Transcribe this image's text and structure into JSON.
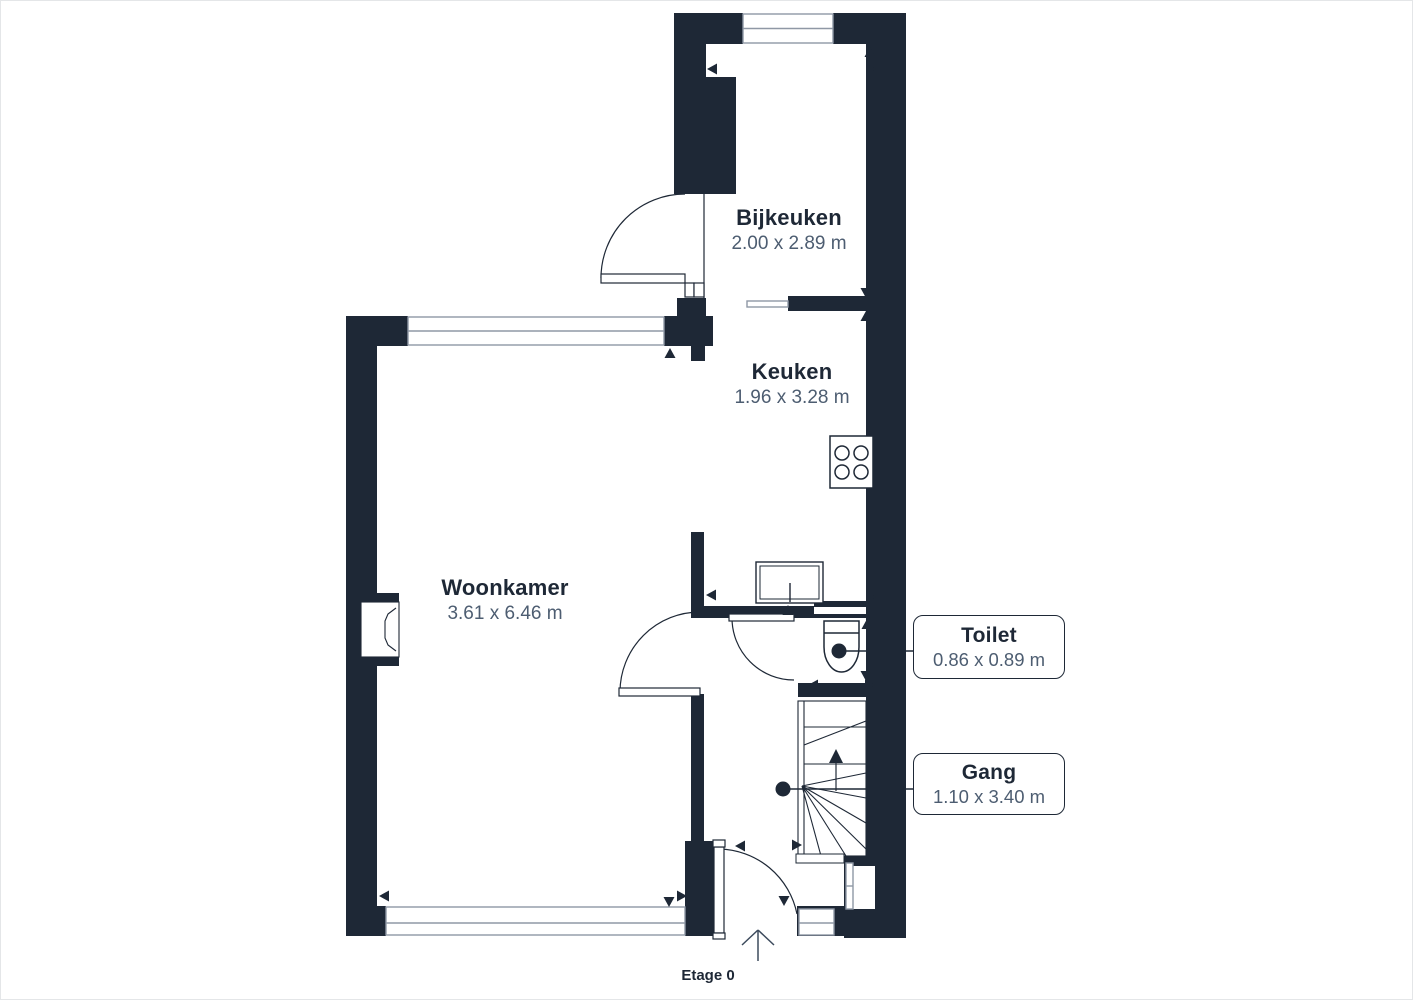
{
  "floor": {
    "label": "Etage 0"
  },
  "rooms": [
    {
      "name": "Bijkeuken",
      "dims": "2.00 x 2.89 m"
    },
    {
      "name": "Keuken",
      "dims": "1.96 x 3.28 m"
    },
    {
      "name": "Woonkamer",
      "dims": "3.61 x 6.46 m"
    },
    {
      "name": "Toilet",
      "dims": "0.86 x 0.89 m"
    },
    {
      "name": "Gang",
      "dims": "1.10 x 3.40 m"
    }
  ],
  "colors": {
    "wall": "#1e2836",
    "dim_text": "#4d5d71",
    "window_line": "#8f98a5",
    "page_border": "#e4e6e8",
    "background": "#ffffff"
  }
}
